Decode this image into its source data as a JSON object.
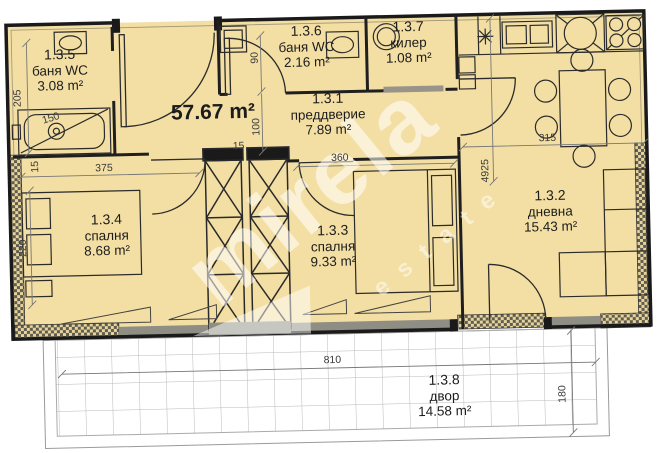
{
  "plan": {
    "total_area": "57.67 m²",
    "rooms": [
      {
        "id": "1.3.5",
        "name": "баня WC",
        "area": "3.08 m²"
      },
      {
        "id": "1.3.6",
        "name": "баня WC",
        "area": "2.16 m²"
      },
      {
        "id": "1.3.7",
        "name": "килер",
        "area": "1.08 m²"
      },
      {
        "id": "1.3.1",
        "name": "преддверие",
        "area": "7.89 m²"
      },
      {
        "id": "1.3.2",
        "name": "дневна",
        "area": "15.43 m²"
      },
      {
        "id": "1.3.3",
        "name": "спалня",
        "area": "9.33 m²"
      },
      {
        "id": "1.3.4",
        "name": "спалня",
        "area": "8.68 m²"
      },
      {
        "id": "1.3.8",
        "name": "двор",
        "area": "14.58 m²"
      }
    ],
    "dimensions": {
      "bath5_height": "205",
      "tub_length": "150",
      "left_small": "15",
      "bath6_door": "90",
      "hall_depth": "100",
      "shaft_gap": "15",
      "bedroom4_width": "375",
      "bedroom4_depth": "220",
      "bedroom3_width": "360",
      "living_width": "315",
      "living_height": "4925",
      "yard_width": "810",
      "yard_depth": "180"
    },
    "watermark": {
      "brand": "mirela",
      "subtitle": "estate"
    },
    "colors": {
      "floor": "#f3dfa4",
      "wall": "#1f1f1f",
      "hatch": "#5f5c50",
      "yard_grid": "#b8b8b8",
      "dimension_text": "#3a3a3a",
      "watermark": "rgba(255,255,255,0.55)"
    }
  }
}
